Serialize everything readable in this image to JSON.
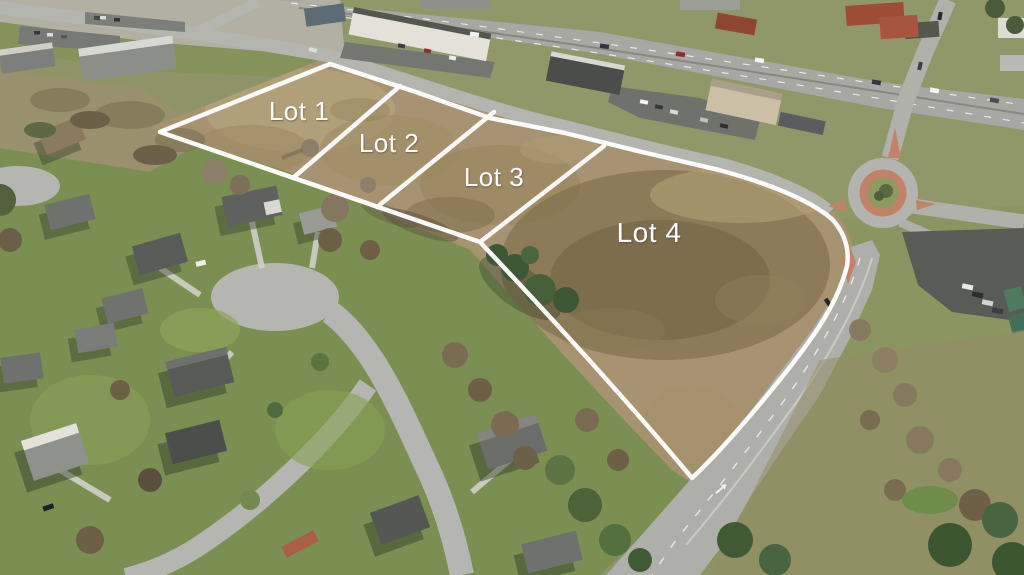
{
  "image": {
    "type": "aerial-photograph",
    "description": "Oblique aerial photo of four vacant commercial land lots outlined in white, bounded by a retail corridor and divided highway to the north, a brick-ringed roundabout and arterial road to the east, and a residential subdivision with cul-de-sac streets to the southwest.",
    "season": "late-autumn"
  },
  "lots": {
    "boundary_color": "#ffffff",
    "label_color": "#ffffff",
    "items": [
      {
        "id": "lot-1",
        "label": "Lot 1"
      },
      {
        "id": "lot-2",
        "label": "Lot 2"
      },
      {
        "id": "lot-3",
        "label": "Lot 3"
      },
      {
        "id": "lot-4",
        "label": "Lot 4"
      }
    ]
  },
  "colors": {
    "field_tan": "#a79372",
    "field_dark": "#6f5f42",
    "grass_green": "#7b8f52",
    "lawn_bright": "#85935a",
    "pavement": "#aeafaa",
    "highway": "#a7a8a3",
    "parking_dark": "#595b57",
    "roundabout_brick": "#c28268",
    "evergreen": "#3f5a34",
    "bare_tree": "#8d7f69",
    "roof_gray": "#5f615f",
    "overlay_white": "#ffffff"
  }
}
